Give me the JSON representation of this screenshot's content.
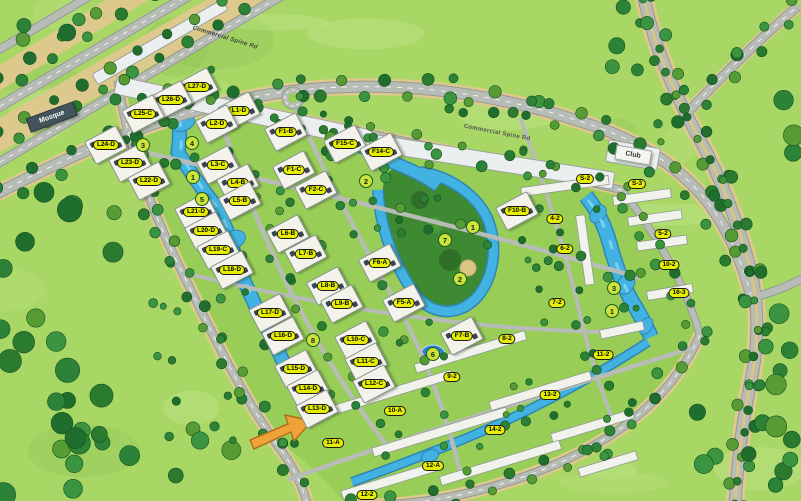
{
  "map": {
    "road_labels": [
      {
        "text": "Commercial Spine Rd"
      },
      {
        "text": "Commercial Spine Rd"
      }
    ],
    "landmarks": [
      {
        "name": "mosque",
        "label": "Mosque"
      },
      {
        "name": "club",
        "label": "Club"
      }
    ],
    "apartment_labels": [
      {
        "text": "L27-D",
        "x": 197,
        "y": 87
      },
      {
        "text": "L26-D",
        "x": 171,
        "y": 100
      },
      {
        "text": "L25-C",
        "x": 143,
        "y": 114
      },
      {
        "text": "L24-D",
        "x": 106,
        "y": 145
      },
      {
        "text": "L23-D",
        "x": 130,
        "y": 163
      },
      {
        "text": "L22-D",
        "x": 149,
        "y": 181
      },
      {
        "text": "L21-D",
        "x": 196,
        "y": 212
      },
      {
        "text": "L20-D",
        "x": 206,
        "y": 231
      },
      {
        "text": "L19-C",
        "x": 218,
        "y": 250
      },
      {
        "text": "L18-D",
        "x": 232,
        "y": 270
      },
      {
        "text": "L17-D",
        "x": 270,
        "y": 313
      },
      {
        "text": "L16-D",
        "x": 283,
        "y": 336
      },
      {
        "text": "L15-D",
        "x": 296,
        "y": 369
      },
      {
        "text": "L14-D",
        "x": 308,
        "y": 389
      },
      {
        "text": "L13-D",
        "x": 317,
        "y": 409
      },
      {
        "text": "L1-D",
        "x": 239,
        "y": 111
      },
      {
        "text": "L2-D",
        "x": 217,
        "y": 124
      },
      {
        "text": "L3-C",
        "x": 218,
        "y": 165
      },
      {
        "text": "L4-B",
        "x": 238,
        "y": 183
      },
      {
        "text": "L5-B",
        "x": 240,
        "y": 201
      },
      {
        "text": "L6-B",
        "x": 288,
        "y": 234
      },
      {
        "text": "L7-B",
        "x": 306,
        "y": 254
      },
      {
        "text": "L8-B",
        "x": 328,
        "y": 286
      },
      {
        "text": "L9-B",
        "x": 342,
        "y": 304
      },
      {
        "text": "L10-C",
        "x": 356,
        "y": 340
      },
      {
        "text": "L11-C",
        "x": 366,
        "y": 362
      },
      {
        "text": "L12-C",
        "x": 374,
        "y": 384
      },
      {
        "text": "F1-B",
        "x": 286,
        "y": 132
      },
      {
        "text": "F15-C",
        "x": 345,
        "y": 144
      },
      {
        "text": "F14-C",
        "x": 381,
        "y": 152
      },
      {
        "text": "F1-C",
        "x": 294,
        "y": 170
      },
      {
        "text": "F2-C",
        "x": 316,
        "y": 190
      },
      {
        "text": "F10-B",
        "x": 517,
        "y": 211
      },
      {
        "text": "F6-A",
        "x": 380,
        "y": 263
      },
      {
        "text": "F5-A",
        "x": 404,
        "y": 303
      },
      {
        "text": "F7-B",
        "x": 462,
        "y": 336
      }
    ],
    "row_labels": [
      {
        "text": "S-2",
        "x": 585,
        "y": 179
      },
      {
        "text": "S-3",
        "x": 637,
        "y": 184
      },
      {
        "text": "4-2",
        "x": 555,
        "y": 219
      },
      {
        "text": "5-2",
        "x": 663,
        "y": 234
      },
      {
        "text": "6-2",
        "x": 565,
        "y": 249
      },
      {
        "text": "10-2",
        "x": 669,
        "y": 265
      },
      {
        "text": "16-3",
        "x": 679,
        "y": 293
      },
      {
        "text": "7-2",
        "x": 557,
        "y": 303
      },
      {
        "text": "8-2",
        "x": 507,
        "y": 339
      },
      {
        "text": "9-2",
        "x": 452,
        "y": 377
      },
      {
        "text": "11-2",
        "x": 603,
        "y": 355
      },
      {
        "text": "13-2",
        "x": 550,
        "y": 395
      },
      {
        "text": "10-A",
        "x": 395,
        "y": 411
      },
      {
        "text": "14-2",
        "x": 495,
        "y": 430
      },
      {
        "text": "11-A",
        "x": 333,
        "y": 443
      },
      {
        "text": "12-A",
        "x": 433,
        "y": 466
      },
      {
        "text": "12-2",
        "x": 367,
        "y": 495
      }
    ],
    "zone_markers": [
      {
        "num": "3",
        "x": 143,
        "y": 145
      },
      {
        "num": "4",
        "x": 192,
        "y": 143
      },
      {
        "num": "1",
        "x": 193,
        "y": 177
      },
      {
        "num": "5",
        "x": 202,
        "y": 199
      },
      {
        "num": "2",
        "x": 366,
        "y": 181
      },
      {
        "num": "1",
        "x": 473,
        "y": 227
      },
      {
        "num": "7",
        "x": 445,
        "y": 240
      },
      {
        "num": "2",
        "x": 460,
        "y": 279
      },
      {
        "num": "8",
        "x": 313,
        "y": 340
      },
      {
        "num": "6",
        "x": 433,
        "y": 354
      },
      {
        "num": "3",
        "x": 614,
        "y": 288
      },
      {
        "num": "1",
        "x": 612,
        "y": 311
      }
    ],
    "colors": {
      "ground": "#a9d766",
      "compound_ground": "#98cd58",
      "park": "#3e8a33",
      "water": "#41b2e2",
      "pool_deep": "#2e7fd6",
      "road": "#b7bcb6",
      "sand": "#dcc98b",
      "building": "#f3f3ec",
      "label_bg": "#e6ef00",
      "zone_bg": "#cde23c",
      "highlight_pointer": "#f0a23a",
      "mosque_bg": "#44545c"
    }
  }
}
